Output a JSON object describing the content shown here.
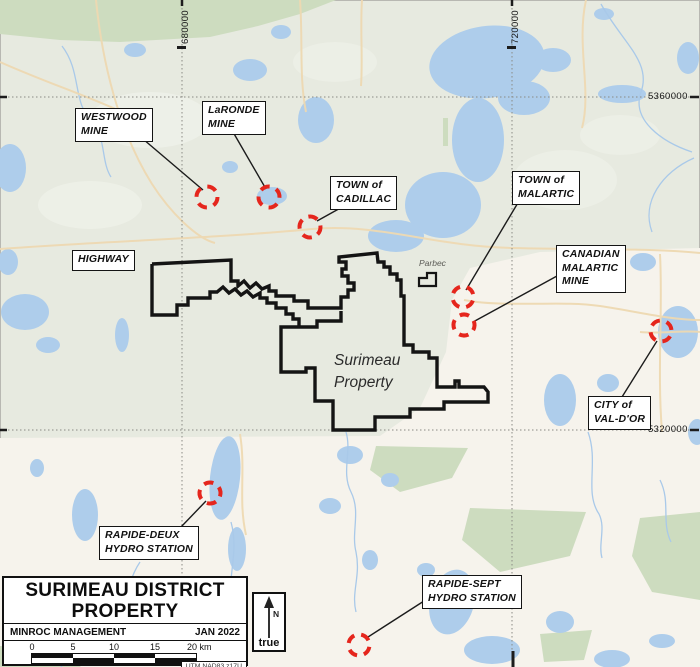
{
  "map": {
    "callouts": {
      "westwood": "WESTWOOD\nMINE",
      "laronde": "LaRONDE\nMINE",
      "cadillac": "TOWN of\nCADILLAC",
      "malartic": "TOWN of\nMALARTIC",
      "canadian_malartic": "CANADIAN\nMALARTIC\nMINE",
      "highway": "HIGHWAY",
      "valdor": "CITY of\nVAL-D'OR",
      "rapide_deux": "RAPIDE-DEUX\nHYDRO STATION",
      "rapide_sept": "RAPIDE-SEPT\nHYDRO STATION"
    },
    "labels": {
      "property": "Surimeau\nProperty",
      "parbec": "Parbec"
    },
    "grid": {
      "eastings": [
        "680000",
        "720000"
      ],
      "northings": [
        "5360000",
        "5320000"
      ]
    }
  },
  "title_block": {
    "title_line1": "SURIMEAU DISTRICT",
    "title_line2": "PROPERTY",
    "company": "MINROC MANAGEMENT",
    "date": "JAN 2022",
    "scale_ticks": [
      "0",
      "5",
      "10",
      "15"
    ],
    "scale_end": "20 km",
    "datum": "UTM NAD83 z17U"
  },
  "north_arrow": {
    "n": "N",
    "true_label": "true"
  },
  "colors": {
    "marker_red": "#e5261d",
    "water": "#aecdeb",
    "forest": "#cddcbf",
    "land_nw": "#e7eae0",
    "land_se": "#f6f3ec",
    "boundary": "#141414"
  }
}
